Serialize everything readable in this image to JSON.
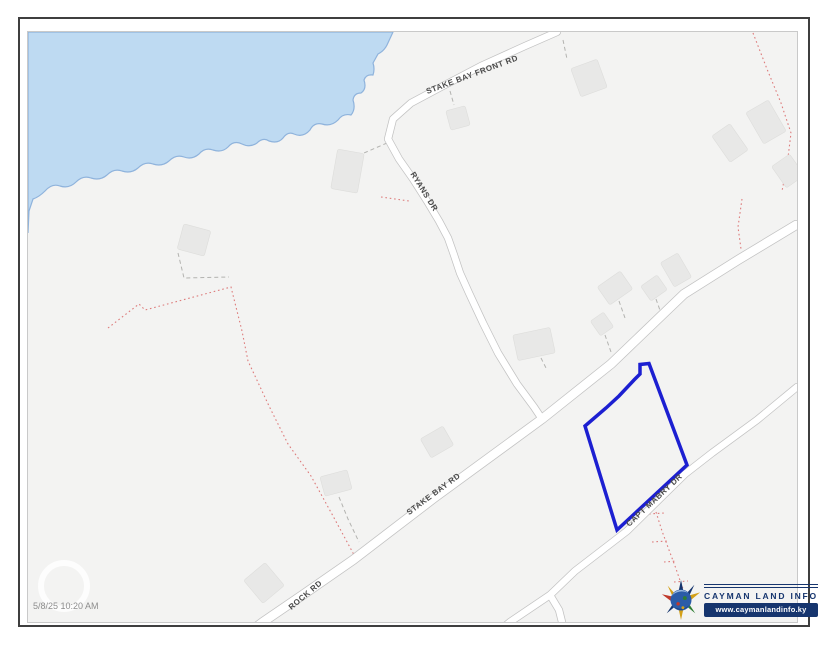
{
  "page": {
    "timestamp": "5/8/25 10:20 AM"
  },
  "map": {
    "road_labels": [
      {
        "id": "stake-bay-front-rd",
        "text": "STAKE BAY FRONT RD"
      },
      {
        "id": "ryans-dr",
        "text": "RYANS DR"
      },
      {
        "id": "stake-bay-rd",
        "text": "STAKE BAY RD"
      },
      {
        "id": "rock-rd",
        "text": "ROCK RD"
      },
      {
        "id": "capt-mabry-dr",
        "text": "CAPT MABRY DR"
      }
    ]
  },
  "logo": {
    "title": "CAYMAN LAND INFO",
    "url": "www.caymanlandinfo.ky"
  },
  "colors": {
    "water": "#bedaf2",
    "water_edge": "#8fb3dc",
    "parcel": "#1c1fd1",
    "navy": "#16356e",
    "road_label": "#4a4a4a",
    "red_boundary": "#dd7b7b",
    "map_bg": "#f3f3f2"
  }
}
